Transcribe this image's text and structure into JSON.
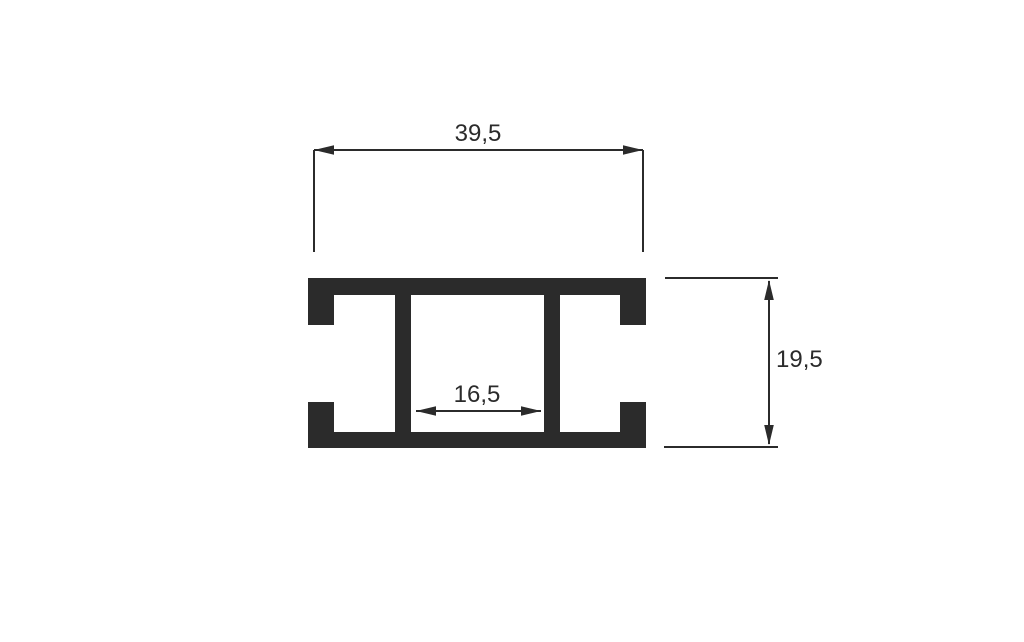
{
  "colors": {
    "ink": "#2b2b2b",
    "background": "#ffffff"
  },
  "drawing": {
    "type": "technical-cross-section",
    "subject": "extruded-profile",
    "dims": {
      "outer_width": "39,5",
      "outer_height": "19,5",
      "inner_width": "16,5"
    }
  }
}
